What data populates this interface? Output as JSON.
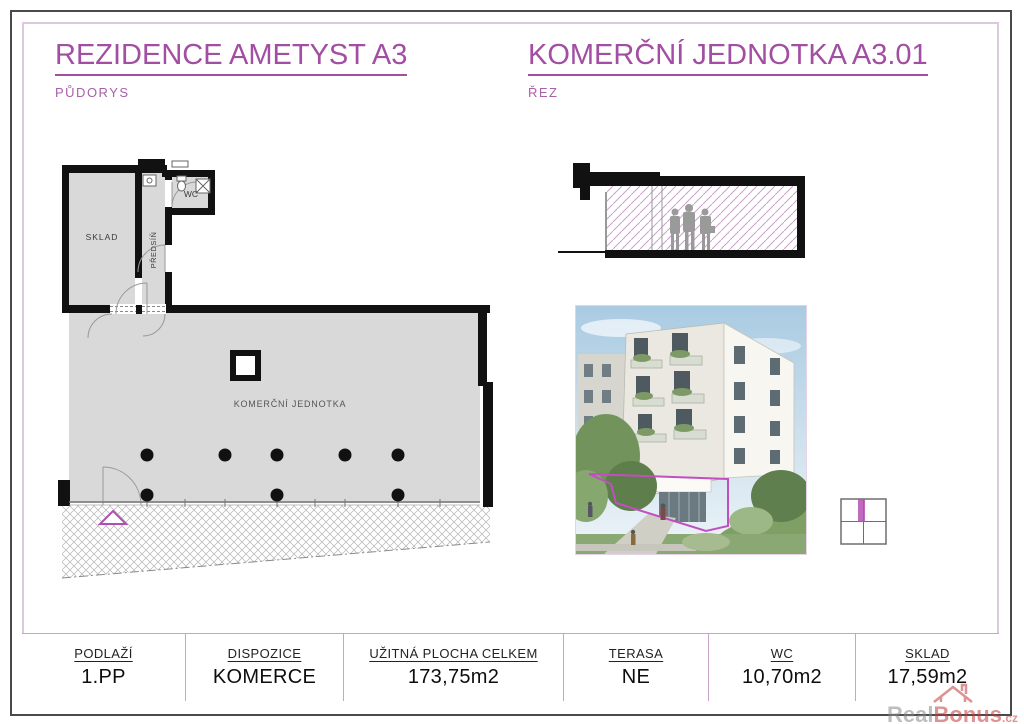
{
  "header": {
    "left_title": "REZIDENCE AMETYST A3",
    "left_subtitle": "PŮDORYS",
    "right_title": "KOMERČNÍ JEDNOTKA A3.01",
    "right_subtitle": "ŘEZ"
  },
  "floor_plan": {
    "rooms": {
      "sklad": "SKLAD",
      "predsin": "PŘEDSÍŇ",
      "wc": "WC",
      "main": "KOMERČNÍ JEDNOTKA"
    }
  },
  "summary_table": {
    "columns": [
      {
        "label": "PODLAŽÍ",
        "value": "1.PP"
      },
      {
        "label": "DISPOZICE",
        "value": "KOMERCE"
      },
      {
        "label": "UŽITNÁ PLOCHA CELKEM",
        "value": "173,75m2"
      },
      {
        "label": "TERASA",
        "value": "NE"
      },
      {
        "label": "WC",
        "value": "10,70m2"
      },
      {
        "label": "SKLAD",
        "value": "17,59m2"
      }
    ]
  },
  "watermark": {
    "part1": "Real",
    "part2": "Bonus",
    "suffix": ".cz",
    "icon": "house-roof-icon"
  },
  "colors": {
    "accent_magenta": "#a24ea2",
    "table_border_pink": "#c9a3c9",
    "inner_border_lavender": "#dcc9de",
    "outer_border_gray": "#4a4a4a",
    "plan_fill_gray": "#d9d9d9",
    "section_hatch_pink": "#c9a2c9",
    "watermark_red": "#c43b3b",
    "unit_outline_magenta": "#c050c0"
  }
}
